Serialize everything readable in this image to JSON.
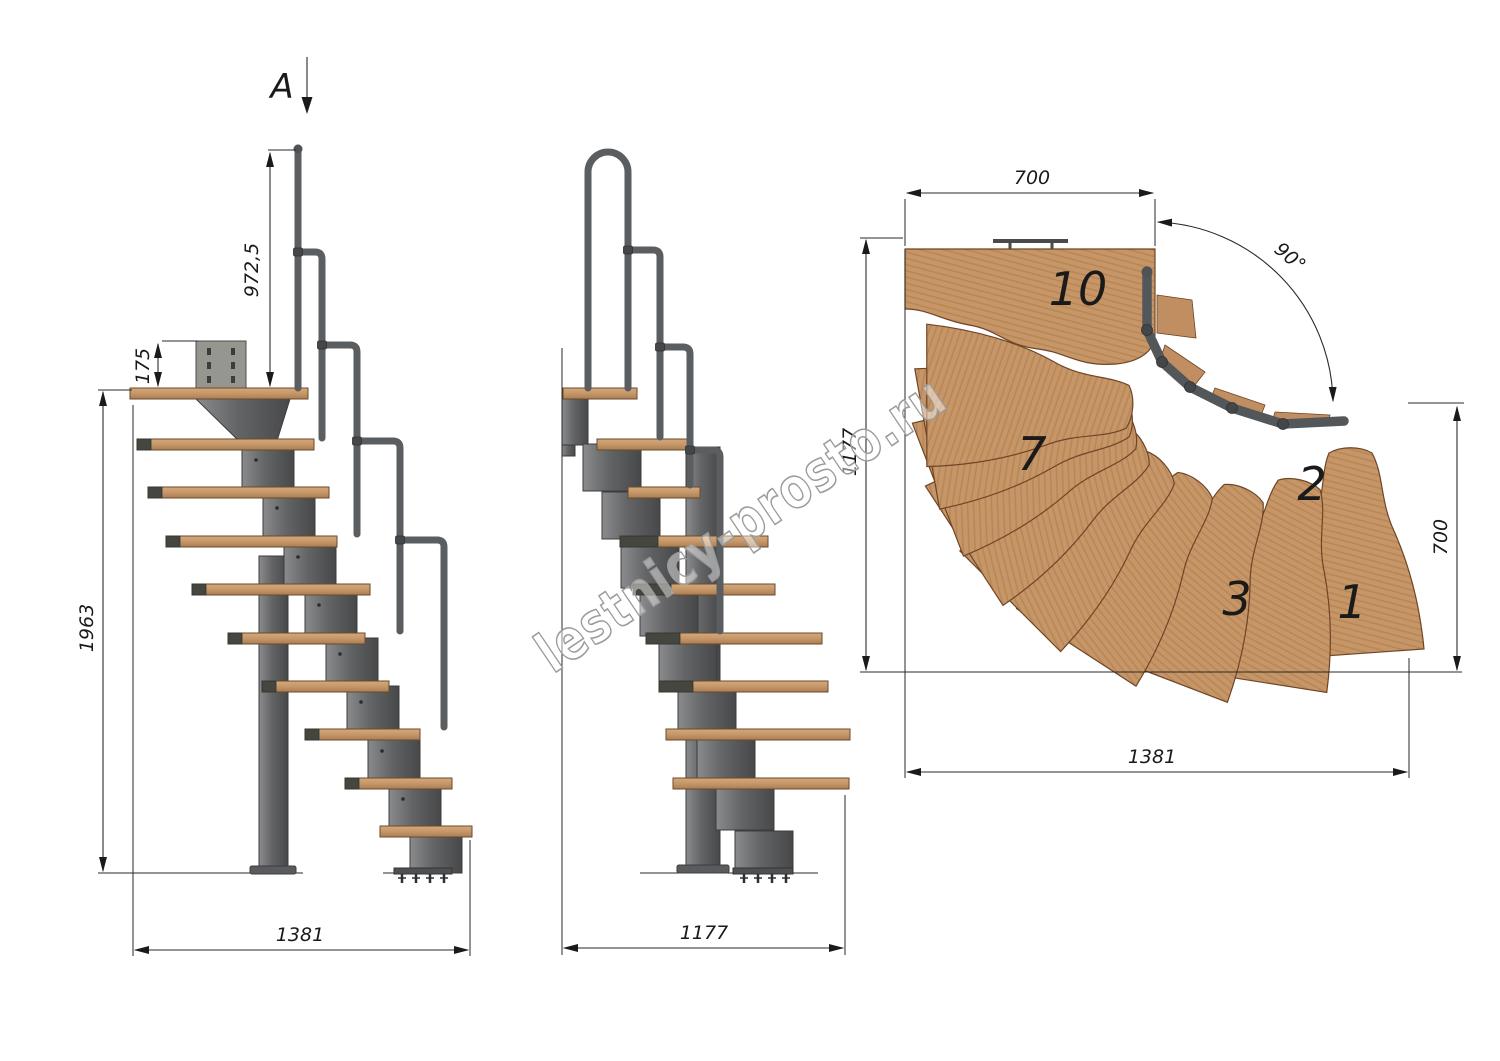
{
  "palette": {
    "background": "#ffffff",
    "line_color": "#2a2a2a",
    "wood_light": "#c79c6e",
    "wood_plan": "#c69667",
    "wood_dark_cap": "#45463f",
    "metal": "#6e6f71",
    "metal_dark": "#4a4b4d",
    "handrail": "#5b5e61",
    "watermark_gray": "#9b9b9b"
  },
  "labels": {
    "section_mark": "A",
    "watermark": "lestnicy-prosto.ru"
  },
  "side_view": {
    "dim_handrail_height": "972,5",
    "dim_bracket_height": "175",
    "dim_total_height": "1963",
    "dim_total_length": "1381"
  },
  "front_view": {
    "dim_total_width": "1177"
  },
  "plan_view": {
    "dim_top_width": "700",
    "dim_turn_angle": "90°",
    "dim_left_depth": "1177",
    "dim_right_depth": "700",
    "dim_bottom_length": "1381",
    "tread_numbers": [
      {
        "label": "10"
      },
      {
        "label": "7"
      },
      {
        "label": "2"
      },
      {
        "label": "3"
      },
      {
        "label": "1"
      }
    ]
  }
}
